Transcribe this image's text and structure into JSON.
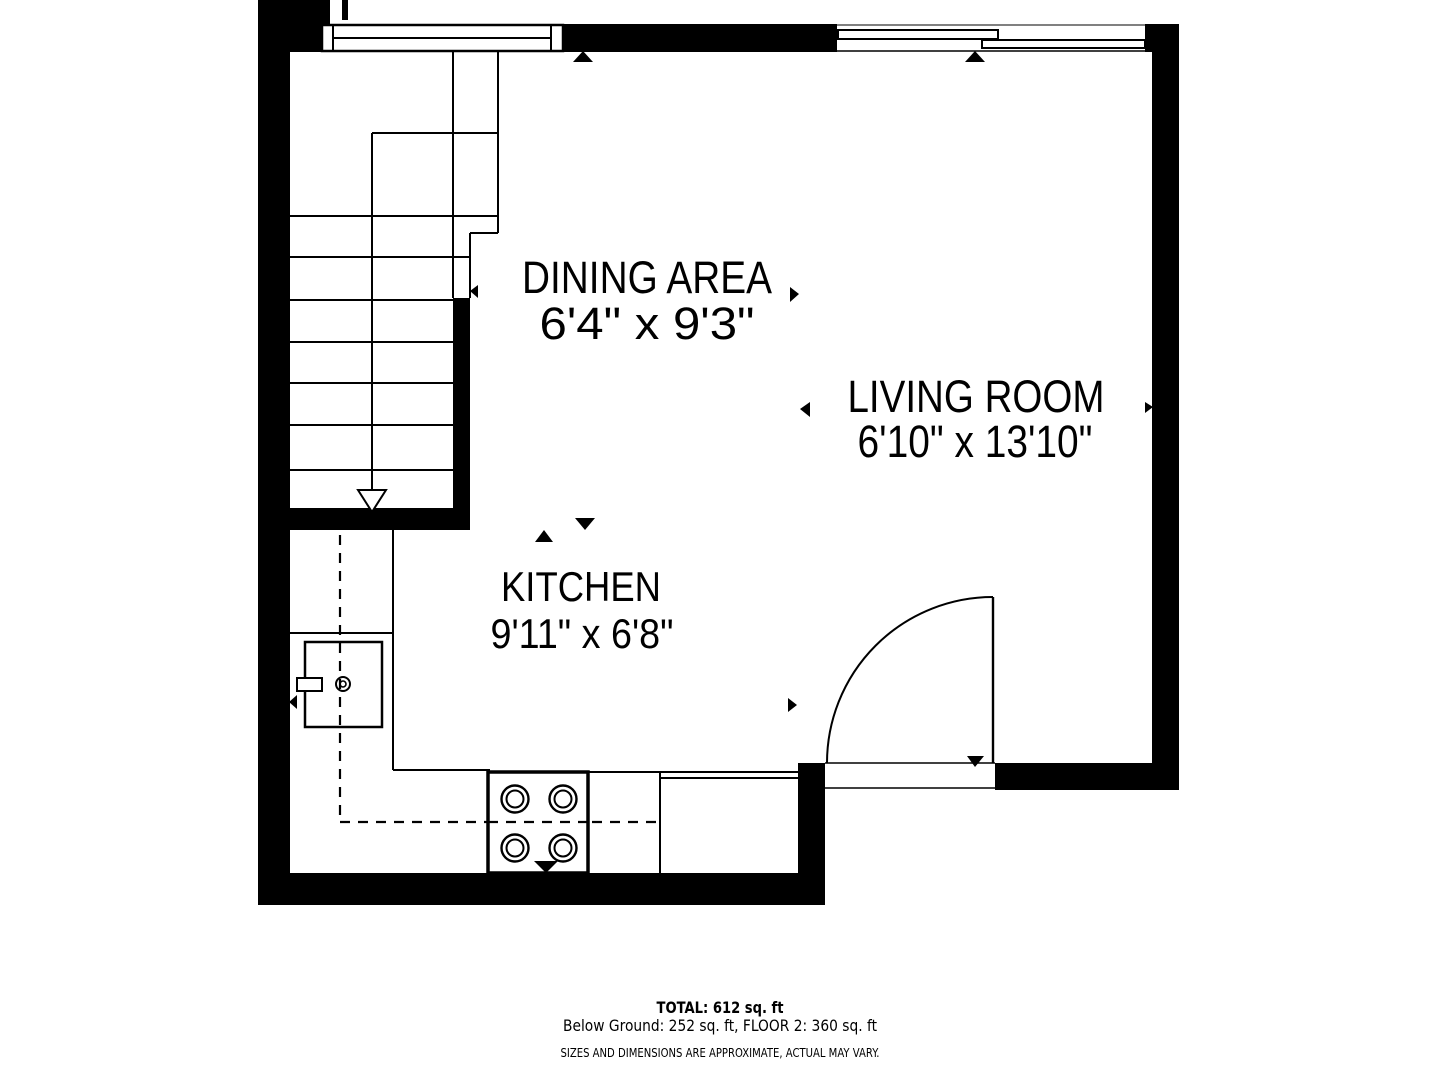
{
  "floor_plan": {
    "rooms": [
      {
        "name": "DINING AREA",
        "dimensions": "6'4\" x 9'3\""
      },
      {
        "name": "LIVING ROOM",
        "dimensions": "6'10\" x 13'10\""
      },
      {
        "name": "KITCHEN",
        "dimensions": "9'11\" x 6'8\""
      }
    ],
    "summary": {
      "total": "TOTAL: 612 sq. ft",
      "breakdown": "Below Ground: 252 sq. ft, FLOOR 2: 360 sq. ft",
      "disclaimer": "SIZES AND DIMENSIONS ARE APPROXIMATE, ACTUAL MAY VARY."
    },
    "icons": {
      "direction_arrow": "filled black triangle marker",
      "stair_direction_arrow": "open triangle arrow pointing down"
    },
    "colors": {
      "line": "#000000",
      "background": "#ffffff"
    }
  }
}
